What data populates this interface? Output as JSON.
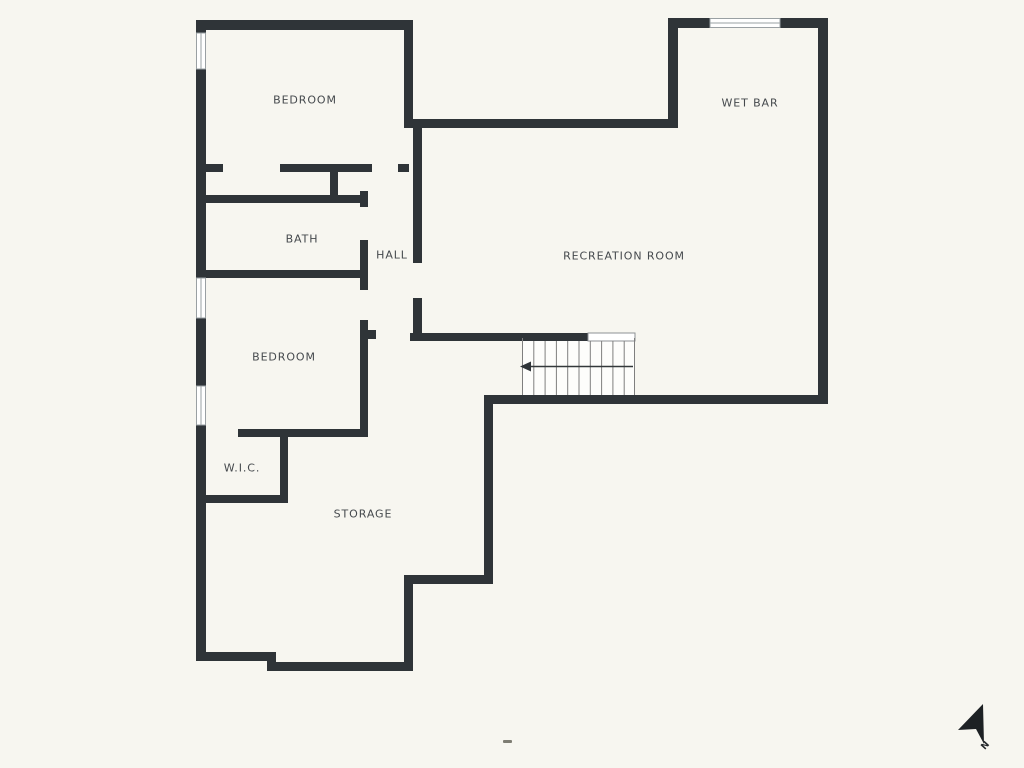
{
  "plan": {
    "type": "floor-plan",
    "rooms": [
      {
        "label": "BEDROOM"
      },
      {
        "label": "WET BAR"
      },
      {
        "label": "BATH"
      },
      {
        "label": "HALL"
      },
      {
        "label": "RECREATION ROOM"
      },
      {
        "label": "BEDROOM"
      },
      {
        "label": "W.I.C."
      },
      {
        "label": "STORAGE"
      }
    ],
    "compass": {
      "label": "N"
    },
    "features": {
      "stairs": {
        "steps": 10,
        "direction": "down-left-arrow"
      },
      "windows": 4
    },
    "colors": {
      "wall": "#2f3438",
      "background": "#f7f6f0",
      "label_text": "#45494d",
      "stair_line": "#7f7f7f",
      "window_border": "#9aa0a3"
    }
  }
}
